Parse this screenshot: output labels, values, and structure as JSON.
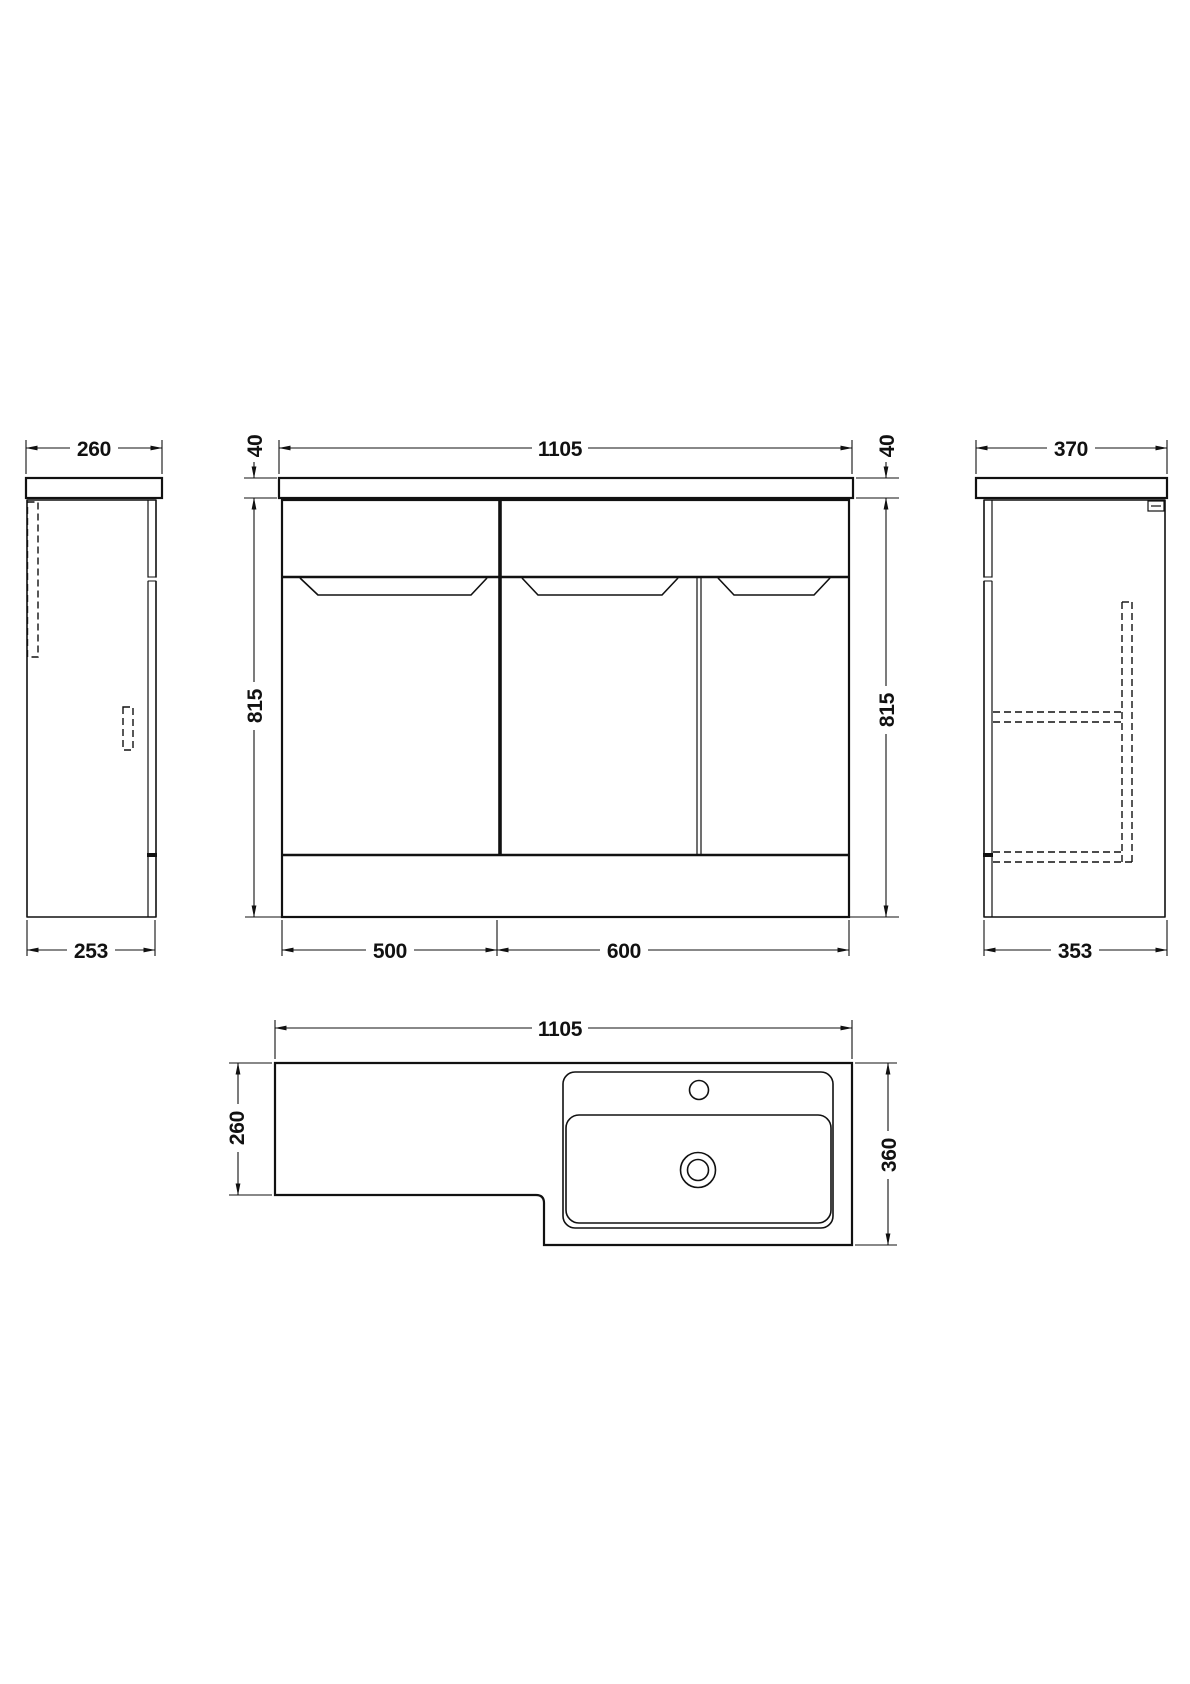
{
  "drawing_type": "bathroom furniture dimension drawing",
  "colors": {
    "line": "#111111",
    "background": "#ffffff"
  },
  "views": {
    "side_left": {
      "dim_top": "260",
      "dim_bottom": "253"
    },
    "front": {
      "dim_width": "1105",
      "dim_worktop_left": "40",
      "dim_worktop_right": "40",
      "dim_height_left": "815",
      "dim_height_right": "815",
      "dim_section_left": "500",
      "dim_section_right": "600"
    },
    "side_right": {
      "dim_top": "370",
      "dim_bottom": "353"
    },
    "plan": {
      "dim_width": "1105",
      "dim_depth_left": "260",
      "dim_depth_right": "360"
    }
  }
}
